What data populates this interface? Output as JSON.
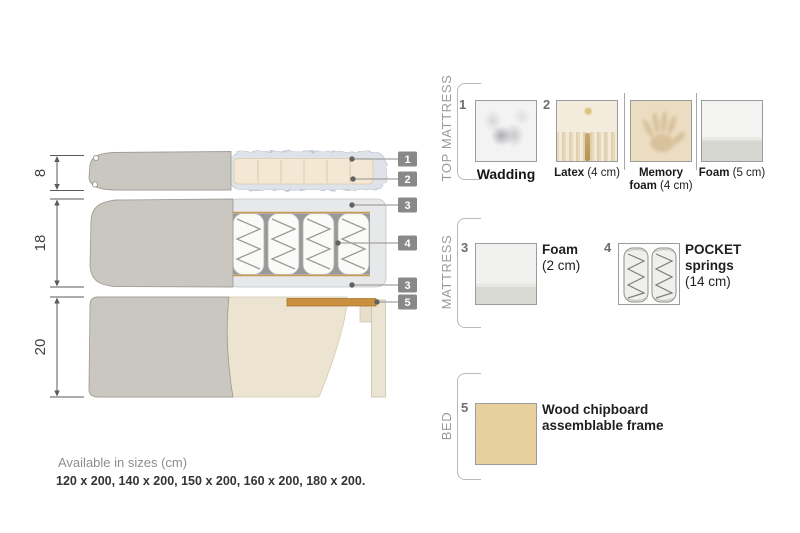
{
  "diagram": {
    "dims": {
      "top_mattress_height": "8",
      "mattress_height": "18",
      "bed_height": "20"
    },
    "callouts": {
      "c1": "1",
      "c2": "2",
      "c3a": "3",
      "c4": "4",
      "c3b": "3",
      "c5": "5"
    }
  },
  "legend": {
    "sections": {
      "top_mattress": {
        "title": "TOP MATTRESS"
      },
      "mattress": {
        "title": "MATTRESS"
      },
      "bed": {
        "title": "BED"
      }
    },
    "items": {
      "wadding": {
        "num": "1",
        "name": "Wadding"
      },
      "latex": {
        "num": "2",
        "name": "Latex",
        "detail": " (4 cm)"
      },
      "memory_foam": {
        "name": "Memory foam",
        "detail": " (4 cm)"
      },
      "foam_5": {
        "name": "Foam",
        "detail": " (5 cm)"
      },
      "foam_2": {
        "num": "3",
        "name": "Foam",
        "detail": "(2 cm)"
      },
      "pocket_springs": {
        "num": "4",
        "name": "POCKET springs",
        "detail": "(14 cm)"
      },
      "chipboard": {
        "num": "5",
        "name": "Wood chipboard assemblable frame"
      }
    }
  },
  "footer": {
    "sizes_title": "Available in sizes (cm)",
    "sizes_list": "120 x 200, 140 x 200, 150 x 200, 160 x 200, 180 x 200."
  },
  "colors": {
    "cover_gray": "#c9c7c0",
    "foam_beige": "#f4e8d4",
    "wadding_blue_gray": "#dfe3e9",
    "mattress_foam": "#e6e8e9",
    "callout_label_gray": "#898989",
    "wood_slat": "#ca9040",
    "chipboard_tan": "#e9d3a1",
    "text_gray": "#9b9b9b"
  }
}
